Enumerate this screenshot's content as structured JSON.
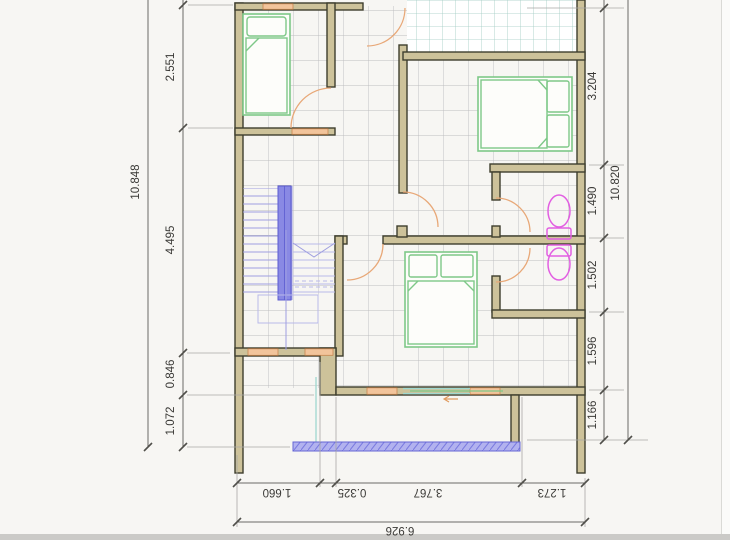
{
  "drawing": {
    "type": "architectural-floor-plan",
    "dims": {
      "left_total": "10.848",
      "left_segments": [
        "2.551",
        "4.495",
        "0.846",
        "1.072"
      ],
      "right_total": "10.820",
      "right_segments": [
        "3.204",
        "1.490",
        "1.502",
        "1.596",
        "1.166"
      ],
      "bottom_total": "6.926",
      "bottom_segments": [
        "1.660",
        "0.325",
        "3.767",
        "1.273"
      ]
    },
    "colors": {
      "background": "#f7f6f3",
      "wall_fill": "#cdc29a",
      "wall_stroke": "#3e3e2d",
      "furniture_green": "#7ec888",
      "stairs_blue": "#8585e2",
      "fixture_magenta": "#e25fe2",
      "door_orange": "#e8a878",
      "window_orange": "#f2c49b",
      "terrace_teal": "#9fcac2",
      "railing_blue": "#7a7ae0",
      "floor_grid_gray": "#bdbdbf",
      "dim_text": "#3a3936"
    },
    "elements": {
      "furniture": [
        "single-bed",
        "double-bed",
        "double-bed"
      ],
      "fixtures": [
        "toilet",
        "toilet"
      ],
      "circulation": [
        "staircase"
      ],
      "outdoor": [
        "terrace",
        "balcony-railing"
      ]
    }
  }
}
